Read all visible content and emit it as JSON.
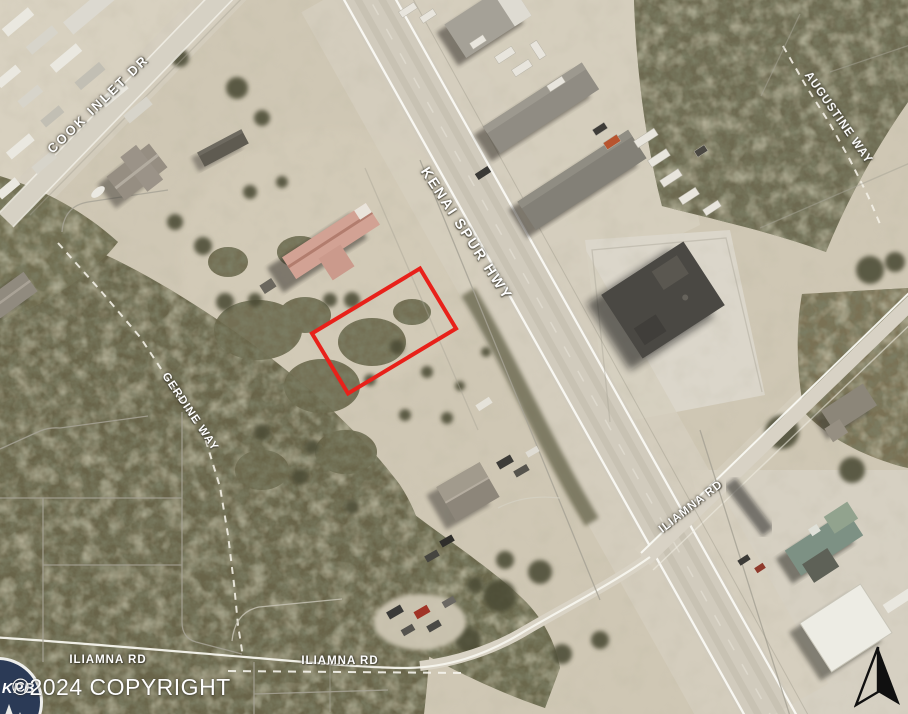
{
  "map": {
    "type": "aerial-parcel-map",
    "road_labels": {
      "cook_inlet_dr": "COOK INLET DR",
      "kenai_spur_hwy": "KENAI SPUR HWY",
      "augustine_way": "AUGUSTINE WAY",
      "gerdine_way": "GERDINE WAY",
      "iliamna_rd_east": "ILIAMNA RD",
      "iliamna_rd_west_1": "ILIAMNA RD",
      "iliamna_rd_west_2": "ILIAMNA RD"
    },
    "parcel_highlight": {
      "color": "#e8211a"
    },
    "watermark": {
      "logo_text": "KPB",
      "copyright_text": "©2024 COPYRIGHT"
    }
  }
}
